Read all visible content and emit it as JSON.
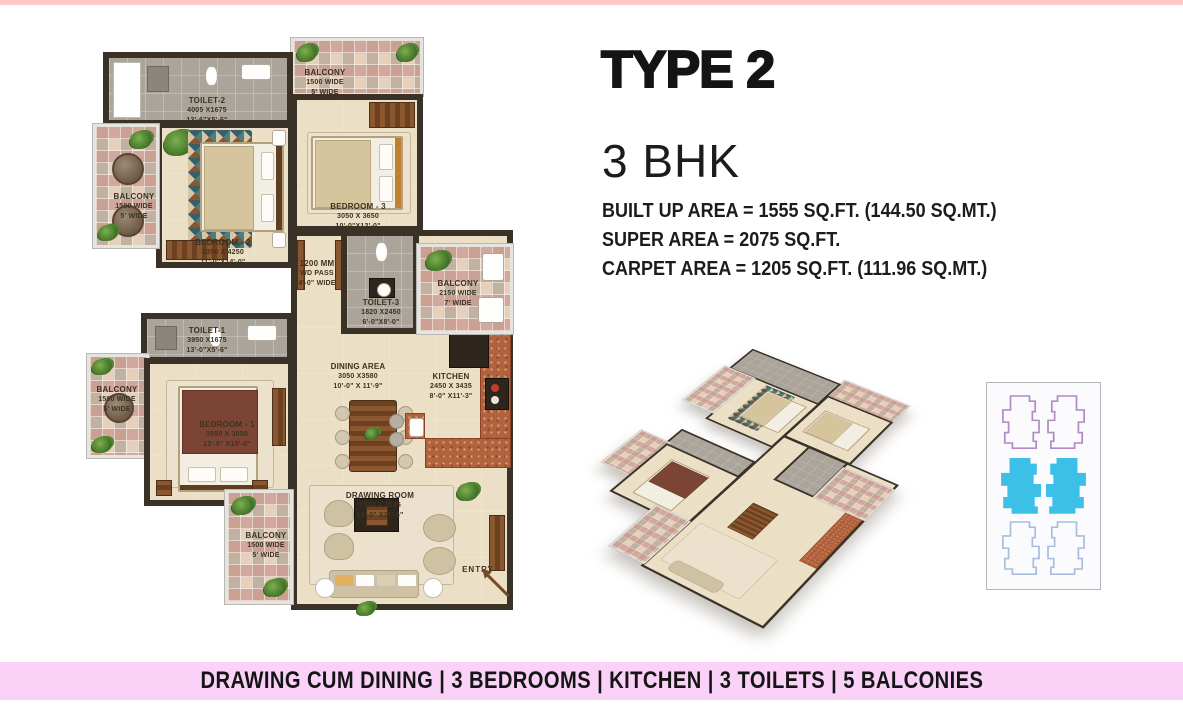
{
  "title": {
    "type_label": "TYPE 2",
    "bhk_label": "3 BHK"
  },
  "areas": {
    "built_up": "BUILT UP AREA = 1555 SQ.FT. (144.50 SQ.MT.)",
    "super_area": "SUPER AREA = 2075 SQ.FT.",
    "carpet": "CARPET AREA = 1205 SQ.FT. (111.96 SQ.MT.)"
  },
  "footer": {
    "summary": "DRAWING CUM DINING | 3 BEDROOMS | KITCHEN | 3 TOILETS | 5 BALCONIES"
  },
  "floor_plan": {
    "rooms": {
      "toilet2": {
        "name": "TOILET-2",
        "mm": "4005 X1675",
        "ft": "13'-6\"X5'-6\""
      },
      "balcony_top": {
        "name": "BALCONY",
        "mm": "1500 WIDE",
        "ft": "5' WIDE"
      },
      "bedroom3": {
        "name": "BEDROOM - 3",
        "mm": "3050 X 3650",
        "ft": "10'-0\"X12'-0\""
      },
      "bedroom2": {
        "name": "BEDROOM - 2",
        "mm": "3350 X 4250",
        "ft": "11'-0\"X14'-0\""
      },
      "balcony_left_upper": {
        "name": "BALCONY",
        "mm": "1500 WIDE",
        "ft": "5' WIDE"
      },
      "wd_pass": {
        "name": "1200 MM",
        "mm": "WD PASS",
        "ft": "4'-0\" WIDE"
      },
      "toilet3": {
        "name": "TOILET-3",
        "mm": "1820 X2450",
        "ft": "6'-0\"X8'-0\""
      },
      "balcony_right": {
        "name": "BALCONY",
        "mm": "2150 WIDE",
        "ft": "7' WIDE"
      },
      "toilet1": {
        "name": "TOILET-1",
        "mm": "3950 X1675",
        "ft": "13'-0\"X5'-6\""
      },
      "balcony_left_lower": {
        "name": "BALCONY",
        "mm": "1500 WIDE",
        "ft": "5' WIDE"
      },
      "bedroom1": {
        "name": "BEDROOM - 1",
        "mm": "3950 X 3050",
        "ft": "13'-0\" X10'-0\""
      },
      "dining": {
        "name": "DINING AREA",
        "mm": "3050 X3580",
        "ft": "10'-0\" X 11'-9\""
      },
      "kitchen": {
        "name": "KITCHEN",
        "mm": "2450 X 3435",
        "ft": "8'-0\" X11'-3\""
      },
      "drawing_room": {
        "name": "DRAWING ROOM",
        "mm": "5500 X 3535",
        "ft": "18'-0\" X11'-6\""
      },
      "balcony_bottom": {
        "name": "BALCONY",
        "mm": "1500 WIDE",
        "ft": "5' WIDE"
      },
      "entry": {
        "label": "ENTRY"
      }
    }
  },
  "colors": {
    "top_bar_pink": "#ffc8ca",
    "footer_pink": "#fad2f7",
    "wall_brown": "#3a3127",
    "floor_beige": "#ebdfc5",
    "toilet_gray": "#aaa49b",
    "kitchen_terracotta": "#b2623c",
    "keyplan_cyan": "#3cc0e8",
    "keyplan_purple": "#b28ac6",
    "keyplan_blue": "#a7bede"
  }
}
